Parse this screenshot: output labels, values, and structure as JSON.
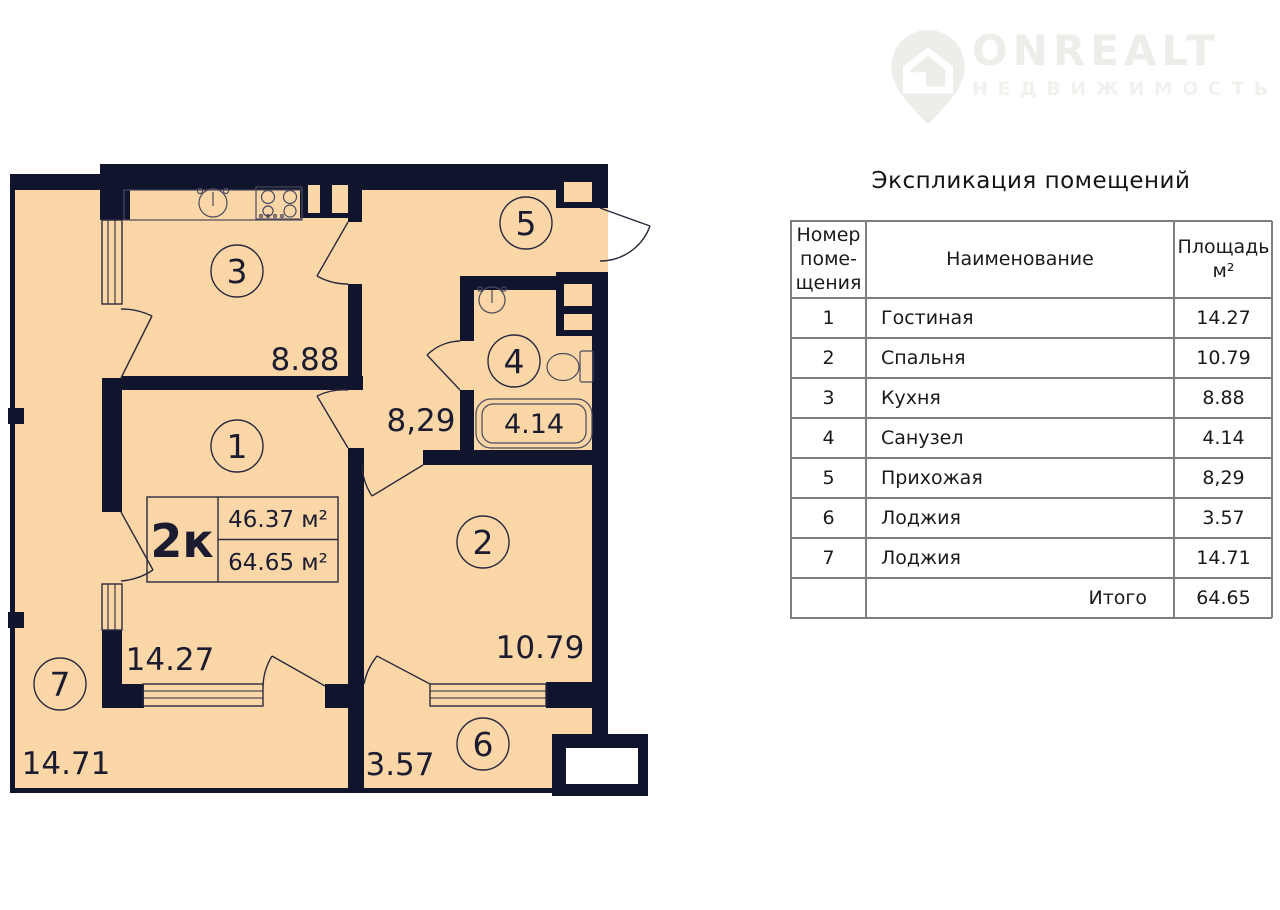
{
  "logo": {
    "name": "ONREALT",
    "subtitle": "НЕДВИЖИМОСТЬ"
  },
  "table": {
    "title": "Экспликация помещений",
    "headers": {
      "number": "Номер\nпоме-\nщения",
      "name": "Наименование",
      "area": "Площадь\nм²"
    },
    "rows": [
      {
        "num": "1",
        "name": "Гостиная",
        "area": "14.27"
      },
      {
        "num": "2",
        "name": "Спальня",
        "area": "10.79"
      },
      {
        "num": "3",
        "name": "Кухня",
        "area": "8.88"
      },
      {
        "num": "4",
        "name": "Санузел",
        "area": "4.14"
      },
      {
        "num": "5",
        "name": "Прихожая",
        "area": "8,29"
      },
      {
        "num": "6",
        "name": "Лоджия",
        "area": "3.57"
      },
      {
        "num": "7",
        "name": "Лоджия",
        "area": "14.71"
      }
    ],
    "total_label": "Итого",
    "total_value": "64.65"
  },
  "plan": {
    "flat_type": "2к",
    "living_area": "46.37 м²",
    "total_area": "64.65 м²",
    "rooms": [
      {
        "num": "1",
        "area": "14.27"
      },
      {
        "num": "2",
        "area": "10.79"
      },
      {
        "num": "3",
        "area": "8.88"
      },
      {
        "num": "4",
        "area": "4.14"
      },
      {
        "num": "5",
        "area": "8,29"
      },
      {
        "num": "6",
        "area": "3.57"
      },
      {
        "num": "7",
        "area": "14.71"
      }
    ]
  },
  "colors": {
    "wall": "#10142d",
    "room_fill": "#fbd6a6",
    "plan_text": "#1c1c30",
    "table_border": "#7e7e7e",
    "logo": "#efedea"
  }
}
